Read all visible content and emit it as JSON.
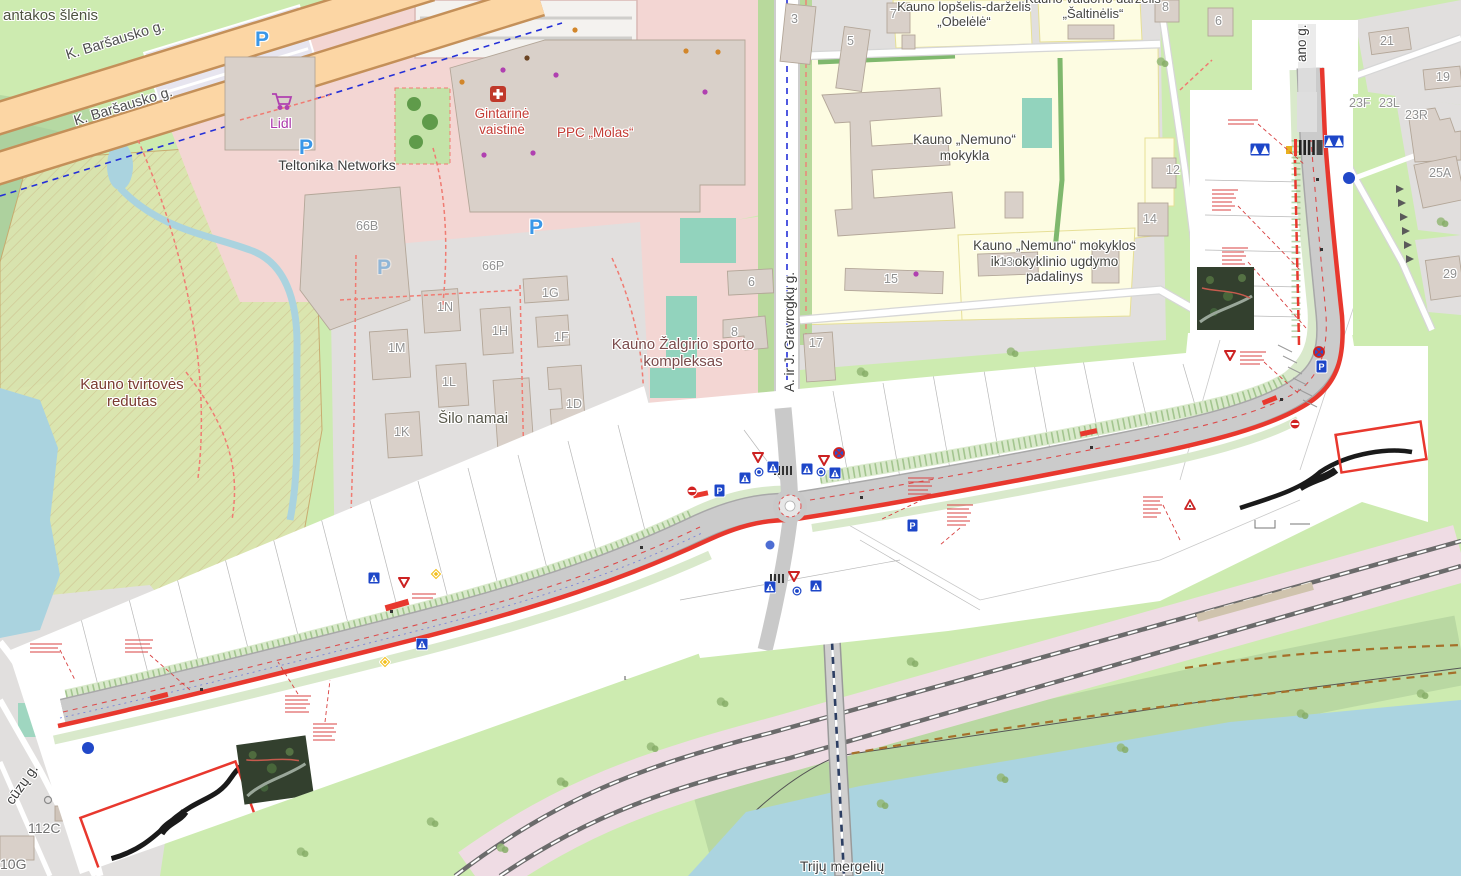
{
  "map": {
    "place_labels": {
      "suburb_fragment": "antakos šlėnis",
      "redutas": "Kauno tvirtovės redutas",
      "silo_namai": "Šilo namai",
      "trys_mergeles_fragment": "Trijų mergelių"
    },
    "street_labels": {
      "barsausko_a": "K. Baršausko g.",
      "barsausko_b": "K. Baršausko g.",
      "gravrogku": "A. ir J. Gravrogkų g.",
      "prancuzu_fragment": "cūzų g.",
      "right_street_fragment": "ano g."
    },
    "poi_labels": {
      "lidl": "Lidl",
      "teltonika": "Teltonika Networks",
      "gintarine": "Gintarinė vaistinė",
      "molas": "PPC „Molas“",
      "zalgirio": "Kauno Žalgirio sporto kompleksas",
      "obelele": "Kauno lopšelis-darželis „Obelėlė“",
      "saltinelis": "Kauno valdorfo darželis „Šaltinėlis“",
      "nemuno_mokykla": "Kauno „Nemuno“ mokykla",
      "nemuno_padalinys": "Kauno „Nemuno“ mokyklos ikimokyklinio ugdymo padalinys"
    },
    "housenumbers": {
      "h3": "3",
      "h5": "5",
      "h7": "7",
      "h8_ne": "8",
      "h6_ne": "6",
      "h21": "21",
      "h19": "19",
      "h23f": "23F",
      "h23l": "23L",
      "h23r": "23R",
      "h25a": "25A",
      "h29": "29",
      "h12": "12",
      "h14": "14",
      "h15": "15",
      "h13": "13",
      "h17": "17",
      "h8_mid": "8",
      "h6_mid": "6",
      "h66b": "66B",
      "h66p": "66P",
      "h1n": "1N",
      "h1m": "1M",
      "h1h": "1H",
      "h1g": "1G",
      "h1f": "1F",
      "h1l": "1L",
      "h1d": "1D",
      "h1k": "1K",
      "h112c": "112C",
      "h10g": "10G"
    },
    "icons": {
      "parking_letter": "P",
      "cart": "shopping-cart-icon",
      "pharmacy": "pharmacy-cross-icon"
    },
    "palette": {
      "water": "#aad3df",
      "grass": "#cdebb0",
      "forest": "#add19e",
      "residential": "#e1dfde",
      "retail_pink": "#f3d6d3",
      "school_yellow": "#fdfce2",
      "building": "#d9d0c9",
      "primary_road": "#fcd6a4",
      "railway_land": "#efdce4",
      "plan_red": "#e8382e",
      "sign_blue": "#1d46c8",
      "parking_blue": "#3a97e8"
    }
  }
}
